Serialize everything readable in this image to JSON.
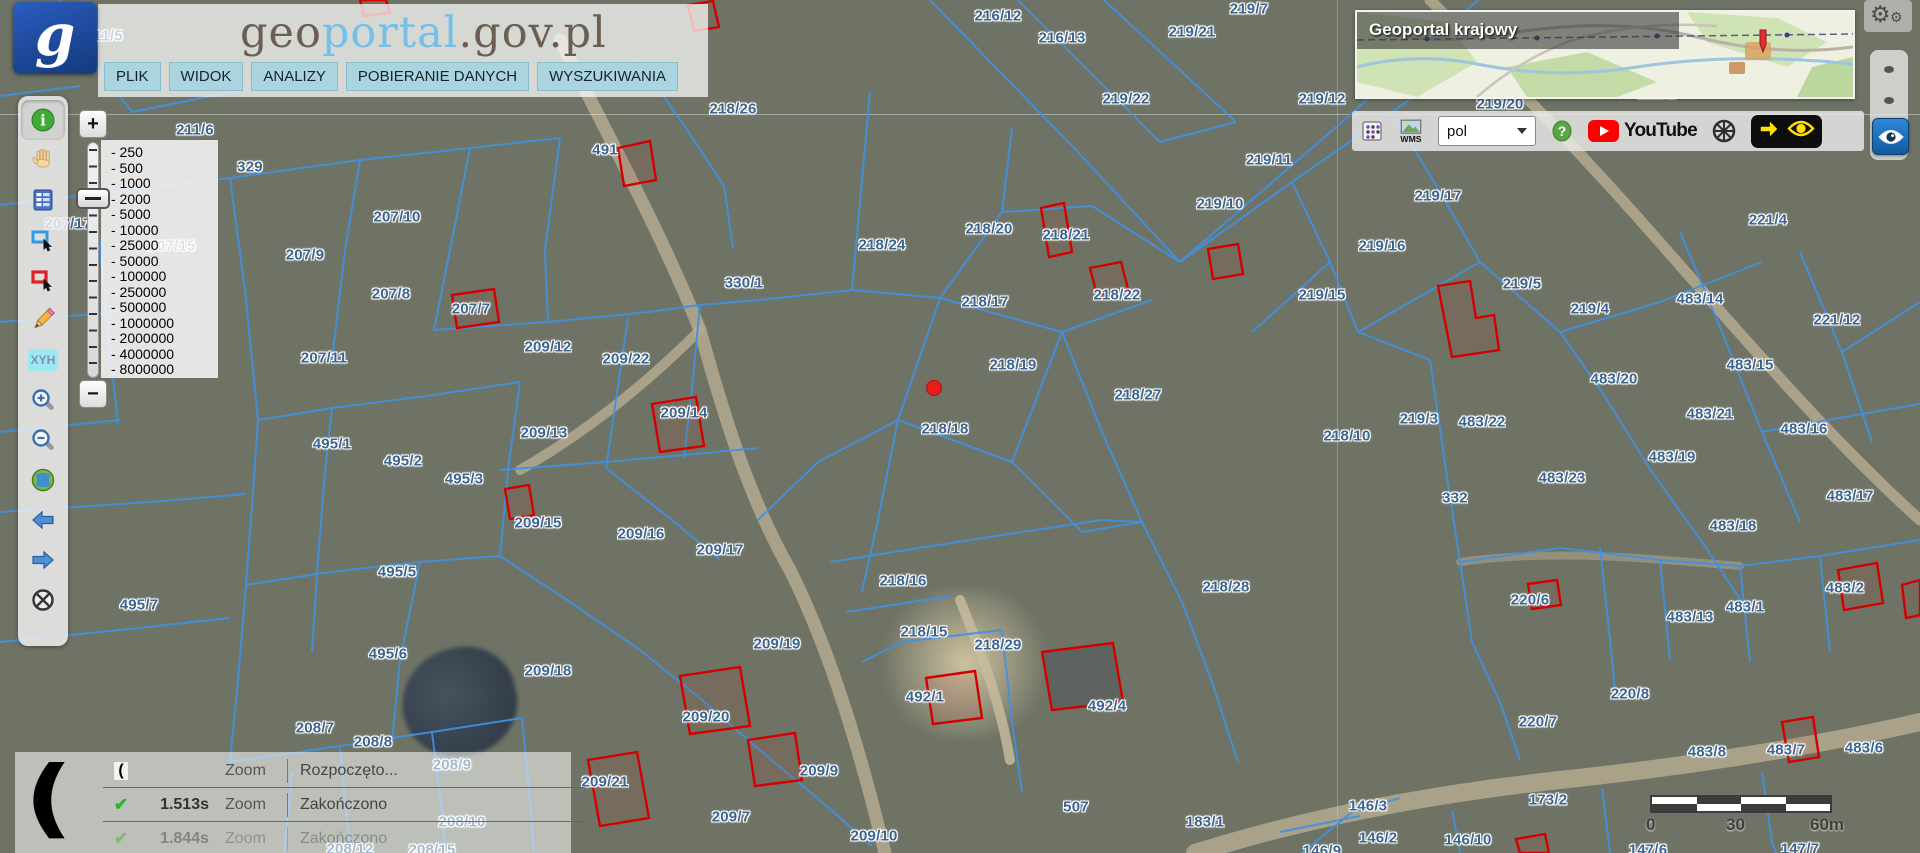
{
  "header": {
    "logo_letter": "g",
    "title": {
      "part1": "geo",
      "part2": "portal",
      "part3": ".gov.pl"
    },
    "menu": [
      {
        "label": "PLIK"
      },
      {
        "label": "WIDOK"
      },
      {
        "label": "ANALIZY"
      },
      {
        "label": "POBIERANIE DANYCH"
      },
      {
        "label": "WYSZUKIWANIA"
      }
    ]
  },
  "left_toolbar": {
    "items": [
      {
        "id": "identify",
        "icon": "info-icon",
        "active": true
      },
      {
        "id": "pan",
        "icon": "hand-icon",
        "active": false
      },
      {
        "id": "legend",
        "icon": "table-icon",
        "active": false
      },
      {
        "id": "select-area",
        "icon": "blue-rect-select-icon",
        "active": false
      },
      {
        "id": "select-obj",
        "icon": "red-rect-select-icon",
        "active": false
      },
      {
        "id": "draw",
        "icon": "pencil-icon",
        "active": false
      },
      {
        "id": "coords",
        "icon": "xyh-icon",
        "text": "XYH",
        "active": false
      },
      {
        "id": "zoom-in",
        "icon": "zoom-in-icon",
        "active": false
      },
      {
        "id": "zoom-out",
        "icon": "zoom-out-icon",
        "active": false
      },
      {
        "id": "full-extent",
        "icon": "globe-icon",
        "active": false
      },
      {
        "id": "back",
        "icon": "arrow-left-icon",
        "active": false
      },
      {
        "id": "forward",
        "icon": "arrow-right-icon",
        "active": false
      },
      {
        "id": "clear",
        "icon": "crossed-circle-icon",
        "active": false
      }
    ]
  },
  "zoom_control": {
    "plus": "+",
    "minus": "−",
    "scales": [
      "250",
      "500",
      "1000",
      "2000",
      "5000",
      "10000",
      "25000",
      "50000",
      "100000",
      "250000",
      "500000",
      "1000000",
      "2000000",
      "4000000",
      "8000000"
    ],
    "selected": "2000"
  },
  "minimap": {
    "title": "Geoportal krajowy"
  },
  "topbar_right": {
    "language_value": "pol",
    "youtube_label": "YouTube"
  },
  "status_panel": {
    "rows": [
      {
        "icon": "moon",
        "time": "",
        "action": "Zoom",
        "status": "Rozpoczęto...",
        "faded": false
      },
      {
        "icon": "check",
        "time": "1.513s",
        "action": "Zoom",
        "status": "Zakończono",
        "faded": false
      },
      {
        "icon": "check",
        "time": "1.844s",
        "action": "Zoom",
        "status": "Zakończono",
        "faded": true
      }
    ]
  },
  "scale_bar": {
    "start": "0",
    "mid": "30",
    "end": "60m"
  },
  "map": {
    "colors": {
      "parcel_line": "#4090e2",
      "building_outline": "#d40000",
      "label": "#3c6490",
      "marker": "#e81c1c"
    },
    "red_marker": {
      "x": 934,
      "y": 388
    },
    "labels": [
      {
        "t": "211/5",
        "x": 104,
        "y": 36
      },
      {
        "t": "211/6",
        "x": 195,
        "y": 130
      },
      {
        "t": "329",
        "x": 250,
        "y": 167
      },
      {
        "t": "491",
        "x": 605,
        "y": 150
      },
      {
        "t": "218/26",
        "x": 733,
        "y": 109
      },
      {
        "t": "216/12",
        "x": 998,
        "y": 16
      },
      {
        "t": "216/13",
        "x": 1062,
        "y": 38
      },
      {
        "t": "219/21",
        "x": 1192,
        "y": 32
      },
      {
        "t": "219/7",
        "x": 1249,
        "y": 9
      },
      {
        "t": "219/22",
        "x": 1126,
        "y": 99
      },
      {
        "t": "219/12",
        "x": 1322,
        "y": 99
      },
      {
        "t": "219/20",
        "x": 1500,
        "y": 104
      },
      {
        "t": "222/2",
        "x": 1657,
        "y": 94
      },
      {
        "t": "224",
        "x": 1791,
        "y": 91
      },
      {
        "t": "219/11",
        "x": 1269,
        "y": 160
      },
      {
        "t": "219/10",
        "x": 1220,
        "y": 204
      },
      {
        "t": "219/17",
        "x": 1438,
        "y": 196
      },
      {
        "t": "219/16",
        "x": 1382,
        "y": 246
      },
      {
        "t": "221/4",
        "x": 1768,
        "y": 220
      },
      {
        "t": "207/17",
        "x": 68,
        "y": 224
      },
      {
        "t": "207/15",
        "x": 172,
        "y": 246
      },
      {
        "t": "207/10",
        "x": 397,
        "y": 217
      },
      {
        "t": "207/9",
        "x": 305,
        "y": 255
      },
      {
        "t": "207/8",
        "x": 391,
        "y": 294
      },
      {
        "t": "207/7",
        "x": 471,
        "y": 309
      },
      {
        "t": "207/11",
        "x": 324,
        "y": 358
      },
      {
        "t": "209/12",
        "x": 548,
        "y": 347
      },
      {
        "t": "209/22",
        "x": 626,
        "y": 359
      },
      {
        "t": "330/1",
        "x": 744,
        "y": 283
      },
      {
        "t": "218/24",
        "x": 882,
        "y": 245
      },
      {
        "t": "218/20",
        "x": 989,
        "y": 229
      },
      {
        "t": "218/21",
        "x": 1066,
        "y": 235
      },
      {
        "t": "218/22",
        "x": 1117,
        "y": 295
      },
      {
        "t": "218/17",
        "x": 985,
        "y": 302
      },
      {
        "t": "218/19",
        "x": 1013,
        "y": 365
      },
      {
        "t": "218/27",
        "x": 1138,
        "y": 395
      },
      {
        "t": "218/18",
        "x": 945,
        "y": 429
      },
      {
        "t": "219/15",
        "x": 1322,
        "y": 295
      },
      {
        "t": "219/5",
        "x": 1522,
        "y": 284
      },
      {
        "t": "219/4",
        "x": 1590,
        "y": 309
      },
      {
        "t": "483/14",
        "x": 1700,
        "y": 299
      },
      {
        "t": "221/12",
        "x": 1837,
        "y": 320
      },
      {
        "t": "483/15",
        "x": 1750,
        "y": 365
      },
      {
        "t": "483/20",
        "x": 1614,
        "y": 379
      },
      {
        "t": "483/21",
        "x": 1710,
        "y": 414
      },
      {
        "t": "483/16",
        "x": 1804,
        "y": 429
      },
      {
        "t": "219/3",
        "x": 1419,
        "y": 419
      },
      {
        "t": "483/22",
        "x": 1482,
        "y": 422
      },
      {
        "t": "218/10",
        "x": 1347,
        "y": 436
      },
      {
        "t": "483/19",
        "x": 1672,
        "y": 457
      },
      {
        "t": "483/23",
        "x": 1562,
        "y": 478
      },
      {
        "t": "332",
        "x": 1455,
        "y": 498
      },
      {
        "t": "483/17",
        "x": 1850,
        "y": 496
      },
      {
        "t": "483/18",
        "x": 1733,
        "y": 526
      },
      {
        "t": "495/1",
        "x": 332,
        "y": 444
      },
      {
        "t": "495/2",
        "x": 403,
        "y": 461
      },
      {
        "t": "495/3",
        "x": 464,
        "y": 479
      },
      {
        "t": "209/13",
        "x": 544,
        "y": 433
      },
      {
        "t": "209/14",
        "x": 684,
        "y": 413
      },
      {
        "t": "209/15",
        "x": 538,
        "y": 523
      },
      {
        "t": "209/16",
        "x": 641,
        "y": 534
      },
      {
        "t": "209/17",
        "x": 720,
        "y": 550
      },
      {
        "t": "218/16",
        "x": 903,
        "y": 581
      },
      {
        "t": "218/15",
        "x": 924,
        "y": 632
      },
      {
        "t": "218/29",
        "x": 998,
        "y": 645
      },
      {
        "t": "218/28",
        "x": 1226,
        "y": 587
      },
      {
        "t": "495/5",
        "x": 397,
        "y": 572
      },
      {
        "t": "495/7",
        "x": 139,
        "y": 605
      },
      {
        "t": "495/6",
        "x": 388,
        "y": 654
      },
      {
        "t": "209/18",
        "x": 548,
        "y": 671
      },
      {
        "t": "209/19",
        "x": 777,
        "y": 644
      },
      {
        "t": "209/20",
        "x": 706,
        "y": 717
      },
      {
        "t": "209/21",
        "x": 605,
        "y": 782
      },
      {
        "t": "209/9",
        "x": 819,
        "y": 771
      },
      {
        "t": "209/7",
        "x": 731,
        "y": 817
      },
      {
        "t": "209/10",
        "x": 874,
        "y": 836
      },
      {
        "t": "492/1",
        "x": 925,
        "y": 697
      },
      {
        "t": "492/4",
        "x": 1107,
        "y": 706
      },
      {
        "t": "507",
        "x": 1076,
        "y": 807
      },
      {
        "t": "183/1",
        "x": 1205,
        "y": 822
      },
      {
        "t": "146/3",
        "x": 1368,
        "y": 806
      },
      {
        "t": "146/2",
        "x": 1378,
        "y": 838
      },
      {
        "t": "146/10",
        "x": 1468,
        "y": 840
      },
      {
        "t": "146/9",
        "x": 1322,
        "y": 851
      },
      {
        "t": "147/6",
        "x": 1648,
        "y": 850
      },
      {
        "t": "147/7",
        "x": 1800,
        "y": 849
      },
      {
        "t": "173/2",
        "x": 1548,
        "y": 800
      },
      {
        "t": "220/6",
        "x": 1530,
        "y": 600
      },
      {
        "t": "220/7",
        "x": 1538,
        "y": 722
      },
      {
        "t": "220/8",
        "x": 1630,
        "y": 694
      },
      {
        "t": "483/13",
        "x": 1690,
        "y": 617
      },
      {
        "t": "483/1",
        "x": 1745,
        "y": 607
      },
      {
        "t": "483/2",
        "x": 1845,
        "y": 588
      },
      {
        "t": "483/8",
        "x": 1707,
        "y": 752
      },
      {
        "t": "483/7",
        "x": 1786,
        "y": 750
      },
      {
        "t": "483/6",
        "x": 1864,
        "y": 748
      },
      {
        "t": "208/7",
        "x": 315,
        "y": 728
      },
      {
        "t": "208/8",
        "x": 373,
        "y": 742
      },
      {
        "t": "208/9",
        "x": 452,
        "y": 765
      },
      {
        "t": "208/10",
        "x": 462,
        "y": 822
      },
      {
        "t": "208/12",
        "x": 350,
        "y": 849
      },
      {
        "t": "208/15",
        "x": 432,
        "y": 850
      }
    ],
    "buildings": [
      {
        "pts": "618,148 650,141 656,180 624,186",
        "dark": false
      },
      {
        "pts": "1041,208 1064,203 1072,252 1049,257",
        "dark": false
      },
      {
        "pts": "1090,268 1121,262 1128,289 1097,295",
        "dark": false
      },
      {
        "pts": "452,295 494,289 499,322 457,328",
        "dark": false
      },
      {
        "pts": "652,404 696,397 704,446 660,452",
        "dark": false
      },
      {
        "pts": "505,489 529,485 534,515 510,519",
        "dark": false
      },
      {
        "pts": "680,676 740,667 750,726 690,734",
        "dark": false
      },
      {
        "pts": "588,760 637,752 649,818 600,826",
        "dark": false
      },
      {
        "pts": "748,740 795,733 802,780 755,786",
        "dark": false
      },
      {
        "pts": "926,678 975,671 982,718 933,724",
        "dark": false
      },
      {
        "pts": "1042,652 1113,643 1123,702 1052,710",
        "dark": true
      },
      {
        "pts": "1438,286 1470,281 1476,318 1494,315 1499,350 1452,357",
        "dark": false
      },
      {
        "pts": "1208,249 1238,244 1243,274 1213,279",
        "dark": false
      },
      {
        "pts": "1528,584 1557,580 1561,605 1532,609",
        "dark": false
      },
      {
        "pts": "1838,570 1877,563 1883,603 1844,610",
        "dark": false
      },
      {
        "pts": "1782,722 1813,717 1819,757 1789,762",
        "dark": false
      },
      {
        "pts": "688,5 713,1 719,27 694,31",
        "dark": false
      },
      {
        "pts": "360,0 386,0 390,13 364,16",
        "dark": false
      },
      {
        "pts": "1516,839 1545,834 1549,853 1520,853",
        "dark": false
      },
      {
        "pts": "1902,585 1920,580 1920,615 1906,618",
        "dark": false
      }
    ]
  }
}
